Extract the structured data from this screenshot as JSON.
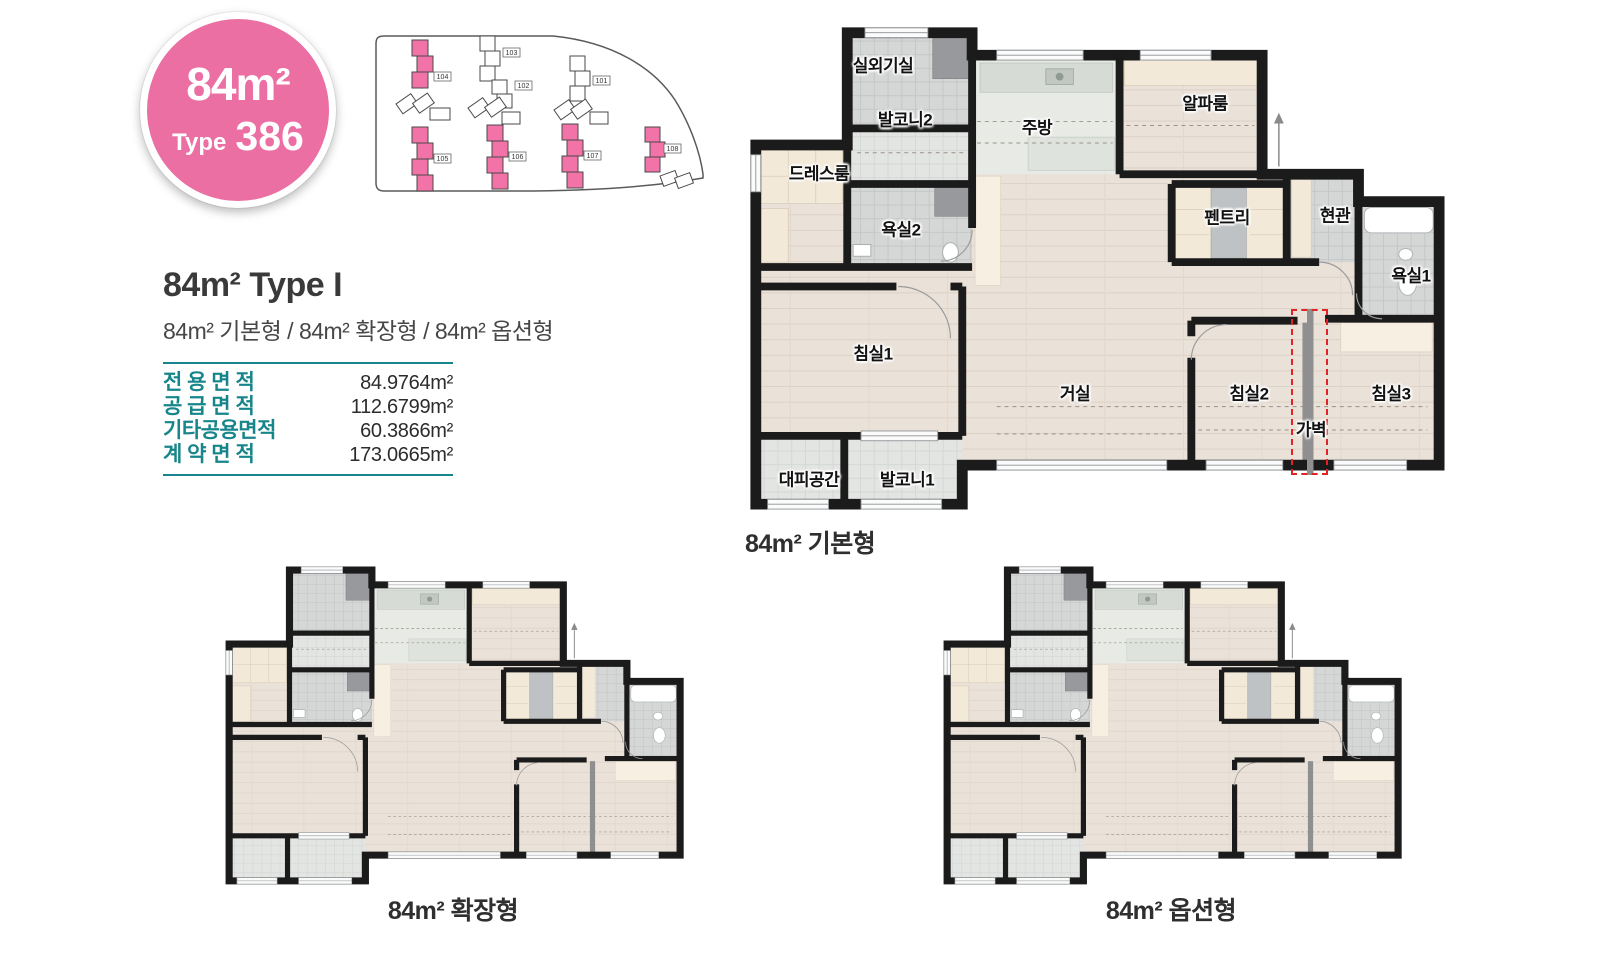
{
  "badge": {
    "area": "84m²",
    "type_label": "Type",
    "type_number": "386"
  },
  "site_plan": {
    "buildings": [
      {
        "id": "104",
        "highlighted": true
      },
      {
        "id": "103",
        "highlighted": false
      },
      {
        "id": "102",
        "highlighted": false
      },
      {
        "id": "101",
        "highlighted": false
      },
      {
        "id": "105",
        "highlighted": true
      },
      {
        "id": "106",
        "highlighted": true
      },
      {
        "id": "107",
        "highlighted": true
      },
      {
        "id": "108",
        "highlighted": true
      }
    ]
  },
  "header": {
    "title": "84m² Type I",
    "subtitle": "84m² 기본형 / 84m² 확장형 / 84m² 옵션형"
  },
  "area_table": {
    "rows": [
      {
        "label": "전 용 면 적",
        "value": "84.9764m²"
      },
      {
        "label": "공 급 면 적",
        "value": "112.6799m²"
      },
      {
        "label": "기타공용면적",
        "value": "60.3866m²"
      },
      {
        "label": "계 약 면 적",
        "value": "173.0665m²"
      }
    ]
  },
  "plans": [
    {
      "caption": "84m² 기본형",
      "rooms": [
        "실외기실",
        "발코니2",
        "주방",
        "알파룸",
        "드레스룸",
        "욕실2",
        "펜트리",
        "현관",
        "욕실1",
        "침실1",
        "거실",
        "침실2",
        "가벽",
        "침실3",
        "대피공간",
        "발코니1"
      ]
    },
    {
      "caption": "84m² 확장형",
      "rooms": []
    },
    {
      "caption": "84m² 옵션형",
      "rooms": []
    }
  ],
  "colors": {
    "badge_pink": "#EC6FA3",
    "accent_teal": "#17868B",
    "highlight_pink": "#F173A7",
    "partition_red": "#E02424",
    "wall_black": "#1B1B1B"
  }
}
